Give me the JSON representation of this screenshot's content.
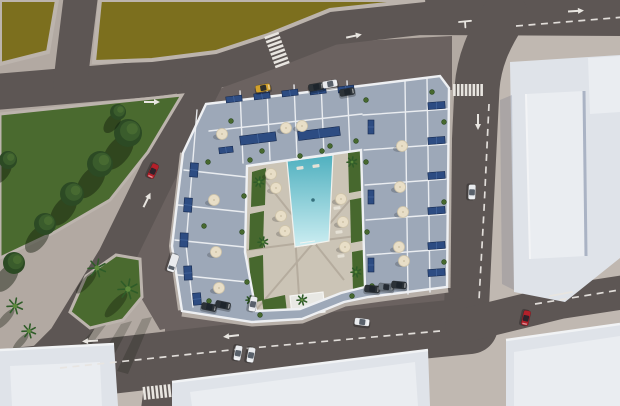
{
  "palette": {
    "base": "#b2a9a2",
    "plaza": "#c0b8b1",
    "apron": "#6b6260",
    "road": "#5d5654",
    "field": "#7c6f1e",
    "fieldDark": "#6e6218",
    "curb": "#bcb4ad",
    "grass": "#4a6a2f",
    "grassDark": "#3f5e28",
    "treeDark": "#2c4a24",
    "treeMid": "#3a5c2c",
    "treeLight": "#476a31",
    "floor": "#9da8b8",
    "floorLight": "#aeb7c5",
    "wall": "#eef0f3",
    "courtyard": "#cbc4b6",
    "deckPath": "#b3aa9c",
    "patch": "#47682e",
    "poolTop": "#4fb0bf",
    "poolBottom": "#cdeef2",
    "panel": "#2d4c82",
    "panelEdge": "#16294e",
    "panelLine": "#4a6ca3",
    "umbrella": "#e8dec7",
    "umbrellaEdge": "#cfc4a9",
    "lounger": "#e5e1d6",
    "building": "#dfe3e9",
    "buildingLight": "#eaedf1",
    "buildingShade": "#aab3c4",
    "marking": "#e8e5e0",
    "sidewalk": "#b7afa8",
    "palmFrond": "#2f5c28",
    "palmCore": "#5d8a3c",
    "carRed": "#b3202a",
    "carWhite": "#e9ebee",
    "carDark": "#2c3237",
    "carGray": "#6d7781",
    "carYellow": "#d2a12c"
  },
  "objects": {
    "park_trees": [
      {
        "x": 128,
        "y": 133,
        "r": 14
      },
      {
        "x": 100,
        "y": 164,
        "r": 13
      },
      {
        "x": 72,
        "y": 194,
        "r": 12
      },
      {
        "x": 45,
        "y": 224,
        "r": 11
      },
      {
        "x": 14,
        "y": 263,
        "r": 11
      },
      {
        "x": 8,
        "y": 160,
        "r": 9
      },
      {
        "x": 118,
        "y": 112,
        "r": 8
      }
    ],
    "palms": [
      {
        "x": 97,
        "y": 268,
        "r": 9,
        "s": true
      },
      {
        "x": 128,
        "y": 289,
        "r": 10,
        "s": true
      },
      {
        "x": 15,
        "y": 306,
        "r": 8,
        "s": true
      },
      {
        "x": 29,
        "y": 331,
        "r": 7,
        "s": true
      },
      {
        "x": 259,
        "y": 182,
        "r": 5
      },
      {
        "x": 263,
        "y": 242,
        "r": 5
      },
      {
        "x": 352,
        "y": 162,
        "r": 5
      },
      {
        "x": 356,
        "y": 272,
        "r": 5
      },
      {
        "x": 302,
        "y": 300,
        "r": 5
      },
      {
        "x": 250,
        "y": 300,
        "r": 4
      }
    ],
    "solar_panels": [
      {
        "x": 226,
        "y": 96,
        "w": 16,
        "h": 6,
        "a": -7
      },
      {
        "x": 254,
        "y": 93,
        "w": 16,
        "h": 6,
        "a": -7
      },
      {
        "x": 282,
        "y": 90,
        "w": 16,
        "h": 6,
        "a": -7
      },
      {
        "x": 310,
        "y": 88,
        "w": 16,
        "h": 6,
        "a": -7
      },
      {
        "x": 338,
        "y": 86,
        "w": 16,
        "h": 6,
        "a": -7
      },
      {
        "x": 240,
        "y": 134,
        "w": 36,
        "h": 9,
        "a": -7
      },
      {
        "x": 298,
        "y": 129,
        "w": 42,
        "h": 9,
        "a": -7
      },
      {
        "x": 219,
        "y": 147,
        "w": 14,
        "h": 6,
        "a": -7
      },
      {
        "x": 428,
        "y": 102,
        "w": 17,
        "h": 7,
        "a": -4
      },
      {
        "x": 428,
        "y": 137,
        "w": 17,
        "h": 7,
        "a": -4
      },
      {
        "x": 428,
        "y": 172,
        "w": 17,
        "h": 7,
        "a": -4
      },
      {
        "x": 428,
        "y": 207,
        "w": 17,
        "h": 7,
        "a": -4
      },
      {
        "x": 428,
        "y": 242,
        "w": 17,
        "h": 7,
        "a": -4
      },
      {
        "x": 428,
        "y": 269,
        "w": 17,
        "h": 7,
        "a": -4
      },
      {
        "x": 368,
        "y": 120,
        "w": 6,
        "h": 14,
        "a": 0
      },
      {
        "x": 368,
        "y": 190,
        "w": 6,
        "h": 14,
        "a": 0
      },
      {
        "x": 368,
        "y": 258,
        "w": 6,
        "h": 14,
        "a": 0
      },
      {
        "x": 190,
        "y": 163,
        "w": 8,
        "h": 14,
        "a": 4
      },
      {
        "x": 184,
        "y": 198,
        "w": 8,
        "h": 14,
        "a": 4
      },
      {
        "x": 180,
        "y": 233,
        "w": 8,
        "h": 14,
        "a": 2
      },
      {
        "x": 184,
        "y": 266,
        "w": 8,
        "h": 14,
        "a": -3
      },
      {
        "x": 193,
        "y": 293,
        "w": 8,
        "h": 12,
        "a": -5
      }
    ],
    "umbrellas": [
      {
        "x": 222,
        "y": 134
      },
      {
        "x": 286,
        "y": 128
      },
      {
        "x": 302,
        "y": 126
      },
      {
        "x": 214,
        "y": 200
      },
      {
        "x": 216,
        "y": 252
      },
      {
        "x": 219,
        "y": 288
      },
      {
        "x": 402,
        "y": 146
      },
      {
        "x": 400,
        "y": 187
      },
      {
        "x": 403,
        "y": 212
      },
      {
        "x": 399,
        "y": 247
      },
      {
        "x": 404,
        "y": 261
      },
      {
        "x": 276,
        "y": 188
      },
      {
        "x": 281,
        "y": 216
      },
      {
        "x": 285,
        "y": 231
      },
      {
        "x": 271,
        "y": 174
      },
      {
        "x": 341,
        "y": 199
      },
      {
        "x": 343,
        "y": 222
      },
      {
        "x": 345,
        "y": 247
      }
    ],
    "loungers": [
      {
        "x": 337,
        "y": 208,
        "a": -6
      },
      {
        "x": 339,
        "y": 232,
        "a": -6
      },
      {
        "x": 341,
        "y": 256,
        "a": -6
      },
      {
        "x": 300,
        "y": 168,
        "a": -8
      },
      {
        "x": 316,
        "y": 166,
        "a": -8
      }
    ],
    "plants": [
      {
        "x": 250,
        "y": 160
      },
      {
        "x": 262,
        "y": 151
      },
      {
        "x": 330,
        "y": 146
      },
      {
        "x": 356,
        "y": 141
      },
      {
        "x": 366,
        "y": 100
      },
      {
        "x": 366,
        "y": 162
      },
      {
        "x": 367,
        "y": 232
      },
      {
        "x": 372,
        "y": 286
      },
      {
        "x": 244,
        "y": 196
      },
      {
        "x": 242,
        "y": 232
      },
      {
        "x": 247,
        "y": 282
      },
      {
        "x": 253,
        "y": 306
      },
      {
        "x": 208,
        "y": 162
      },
      {
        "x": 204,
        "y": 226
      },
      {
        "x": 209,
        "y": 301
      },
      {
        "x": 300,
        "y": 156
      },
      {
        "x": 322,
        "y": 151
      },
      {
        "x": 432,
        "y": 92
      },
      {
        "x": 444,
        "y": 122
      },
      {
        "x": 444,
        "y": 202
      },
      {
        "x": 444,
        "y": 262
      },
      {
        "x": 231,
        "y": 121
      },
      {
        "x": 352,
        "y": 296
      },
      {
        "x": 260,
        "y": 315
      }
    ],
    "cars": [
      {
        "name": "car-red-diagonal-road",
        "x": 153,
        "y": 171,
        "angle": 115,
        "color": "red"
      },
      {
        "name": "car-white-right-road",
        "x": 472,
        "y": 192,
        "angle": 92,
        "color": "white"
      },
      {
        "name": "car-red-bottom-right-road",
        "x": 526,
        "y": 318,
        "angle": 103,
        "color": "red"
      },
      {
        "name": "car-white-bottom-road",
        "x": 362,
        "y": 322,
        "angle": 7,
        "color": "white"
      },
      {
        "name": "car-white-bottom-road-2",
        "x": 238,
        "y": 353,
        "angle": 100,
        "color": "white"
      },
      {
        "name": "car-white-bottom-road-3",
        "x": 251,
        "y": 355,
        "angle": 100,
        "color": "white"
      },
      {
        "name": "car-yellow-parked-north",
        "x": 263,
        "y": 88,
        "angle": -10,
        "color": "yellow"
      },
      {
        "name": "car-dark-parked-north",
        "x": 316,
        "y": 87,
        "angle": -10,
        "color": "dark"
      },
      {
        "name": "car-white-parked-north",
        "x": 330,
        "y": 84,
        "angle": -10,
        "color": "white"
      },
      {
        "name": "car-dark-parked-north-2",
        "x": 347,
        "y": 92,
        "angle": -10,
        "color": "dark"
      },
      {
        "name": "van-white-parked-west",
        "x": 173,
        "y": 263,
        "angle": 108,
        "color": "white",
        "van": true
      },
      {
        "name": "car-dark-parked-south-1",
        "x": 209,
        "y": 307,
        "angle": 12,
        "color": "dark"
      },
      {
        "name": "car-dark-parked-south-2",
        "x": 223,
        "y": 305,
        "angle": 12,
        "color": "dark"
      },
      {
        "name": "car-white-parked-south",
        "x": 253,
        "y": 304,
        "angle": 100,
        "color": "white"
      },
      {
        "name": "car-dark-parked-south-3",
        "x": 372,
        "y": 289,
        "angle": 5,
        "color": "dark"
      },
      {
        "name": "car-gray-parked-south",
        "x": 386,
        "y": 287,
        "angle": 5,
        "color": "gray"
      },
      {
        "name": "car-dark-parked-south-4",
        "x": 399,
        "y": 285,
        "angle": 5,
        "color": "dark"
      }
    ],
    "markings": {
      "arrows": [
        {
          "x": 152,
          "y": 102,
          "a": 0
        },
        {
          "x": 354,
          "y": 36,
          "a": -12
        },
        {
          "x": 576,
          "y": 11,
          "a": -4
        },
        {
          "x": 478,
          "y": 122,
          "a": 90
        },
        {
          "x": 147,
          "y": 200,
          "a": -64
        },
        {
          "x": 231,
          "y": 336,
          "a": 174
        },
        {
          "x": 90,
          "y": 341,
          "a": 176
        }
      ],
      "crosswalks": [
        {
          "x": 277,
          "y": 50,
          "a": 70,
          "n": 8,
          "len": 15,
          "step": 4.4
        },
        {
          "x": 468,
          "y": 90,
          "a": 0,
          "n": 8,
          "len": 12,
          "step": 3.9
        },
        {
          "x": 157,
          "y": 392,
          "a": -6,
          "n": 7,
          "len": 13,
          "step": 4.2
        }
      ],
      "dashes": [
        {
          "d": "M516,26 L625,17"
        },
        {
          "d": "M489,104 L484,210 L479,300"
        },
        {
          "d": "M60,368 L240,349 L440,331"
        },
        {
          "d": "M535,304 L625,289"
        }
      ],
      "solid_lines": [
        {
          "d": "M550,296 L572,292"
        },
        {
          "d": "M459,22 l12,-1.2"
        },
        {
          "d": "M465,21.4 l0.4,6"
        }
      ]
    }
  }
}
